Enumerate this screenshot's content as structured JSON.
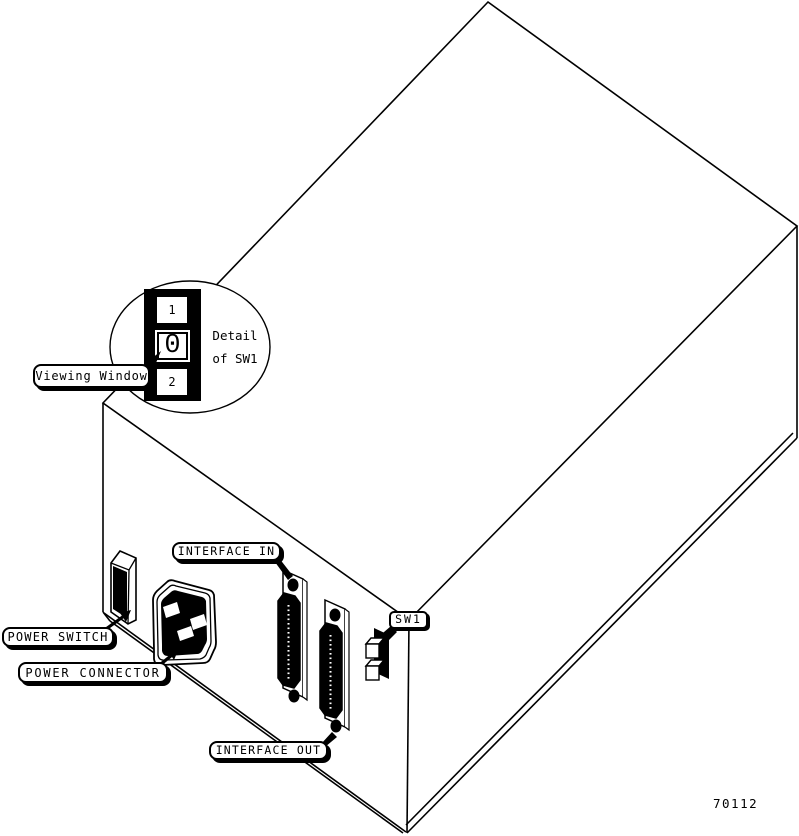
{
  "figure": {
    "number": "70112",
    "description": "Rear-panel isometric line drawing of device with switch detail callout"
  },
  "detail_callout": {
    "title_line1": "Detail",
    "title_line2": "of SW1",
    "switch_positions": [
      "1",
      "0",
      "2"
    ],
    "current_position": "0"
  },
  "labels": {
    "viewing_window": "Viewing Window",
    "power_switch": "POWER SWITCH",
    "power_connector": "POWER CONNECTOR",
    "interface_in": "INTERFACE IN",
    "interface_out": "INTERFACE OUT",
    "sw1": "SW1"
  },
  "colors": {
    "ink": "#000000",
    "paper": "#ffffff"
  }
}
